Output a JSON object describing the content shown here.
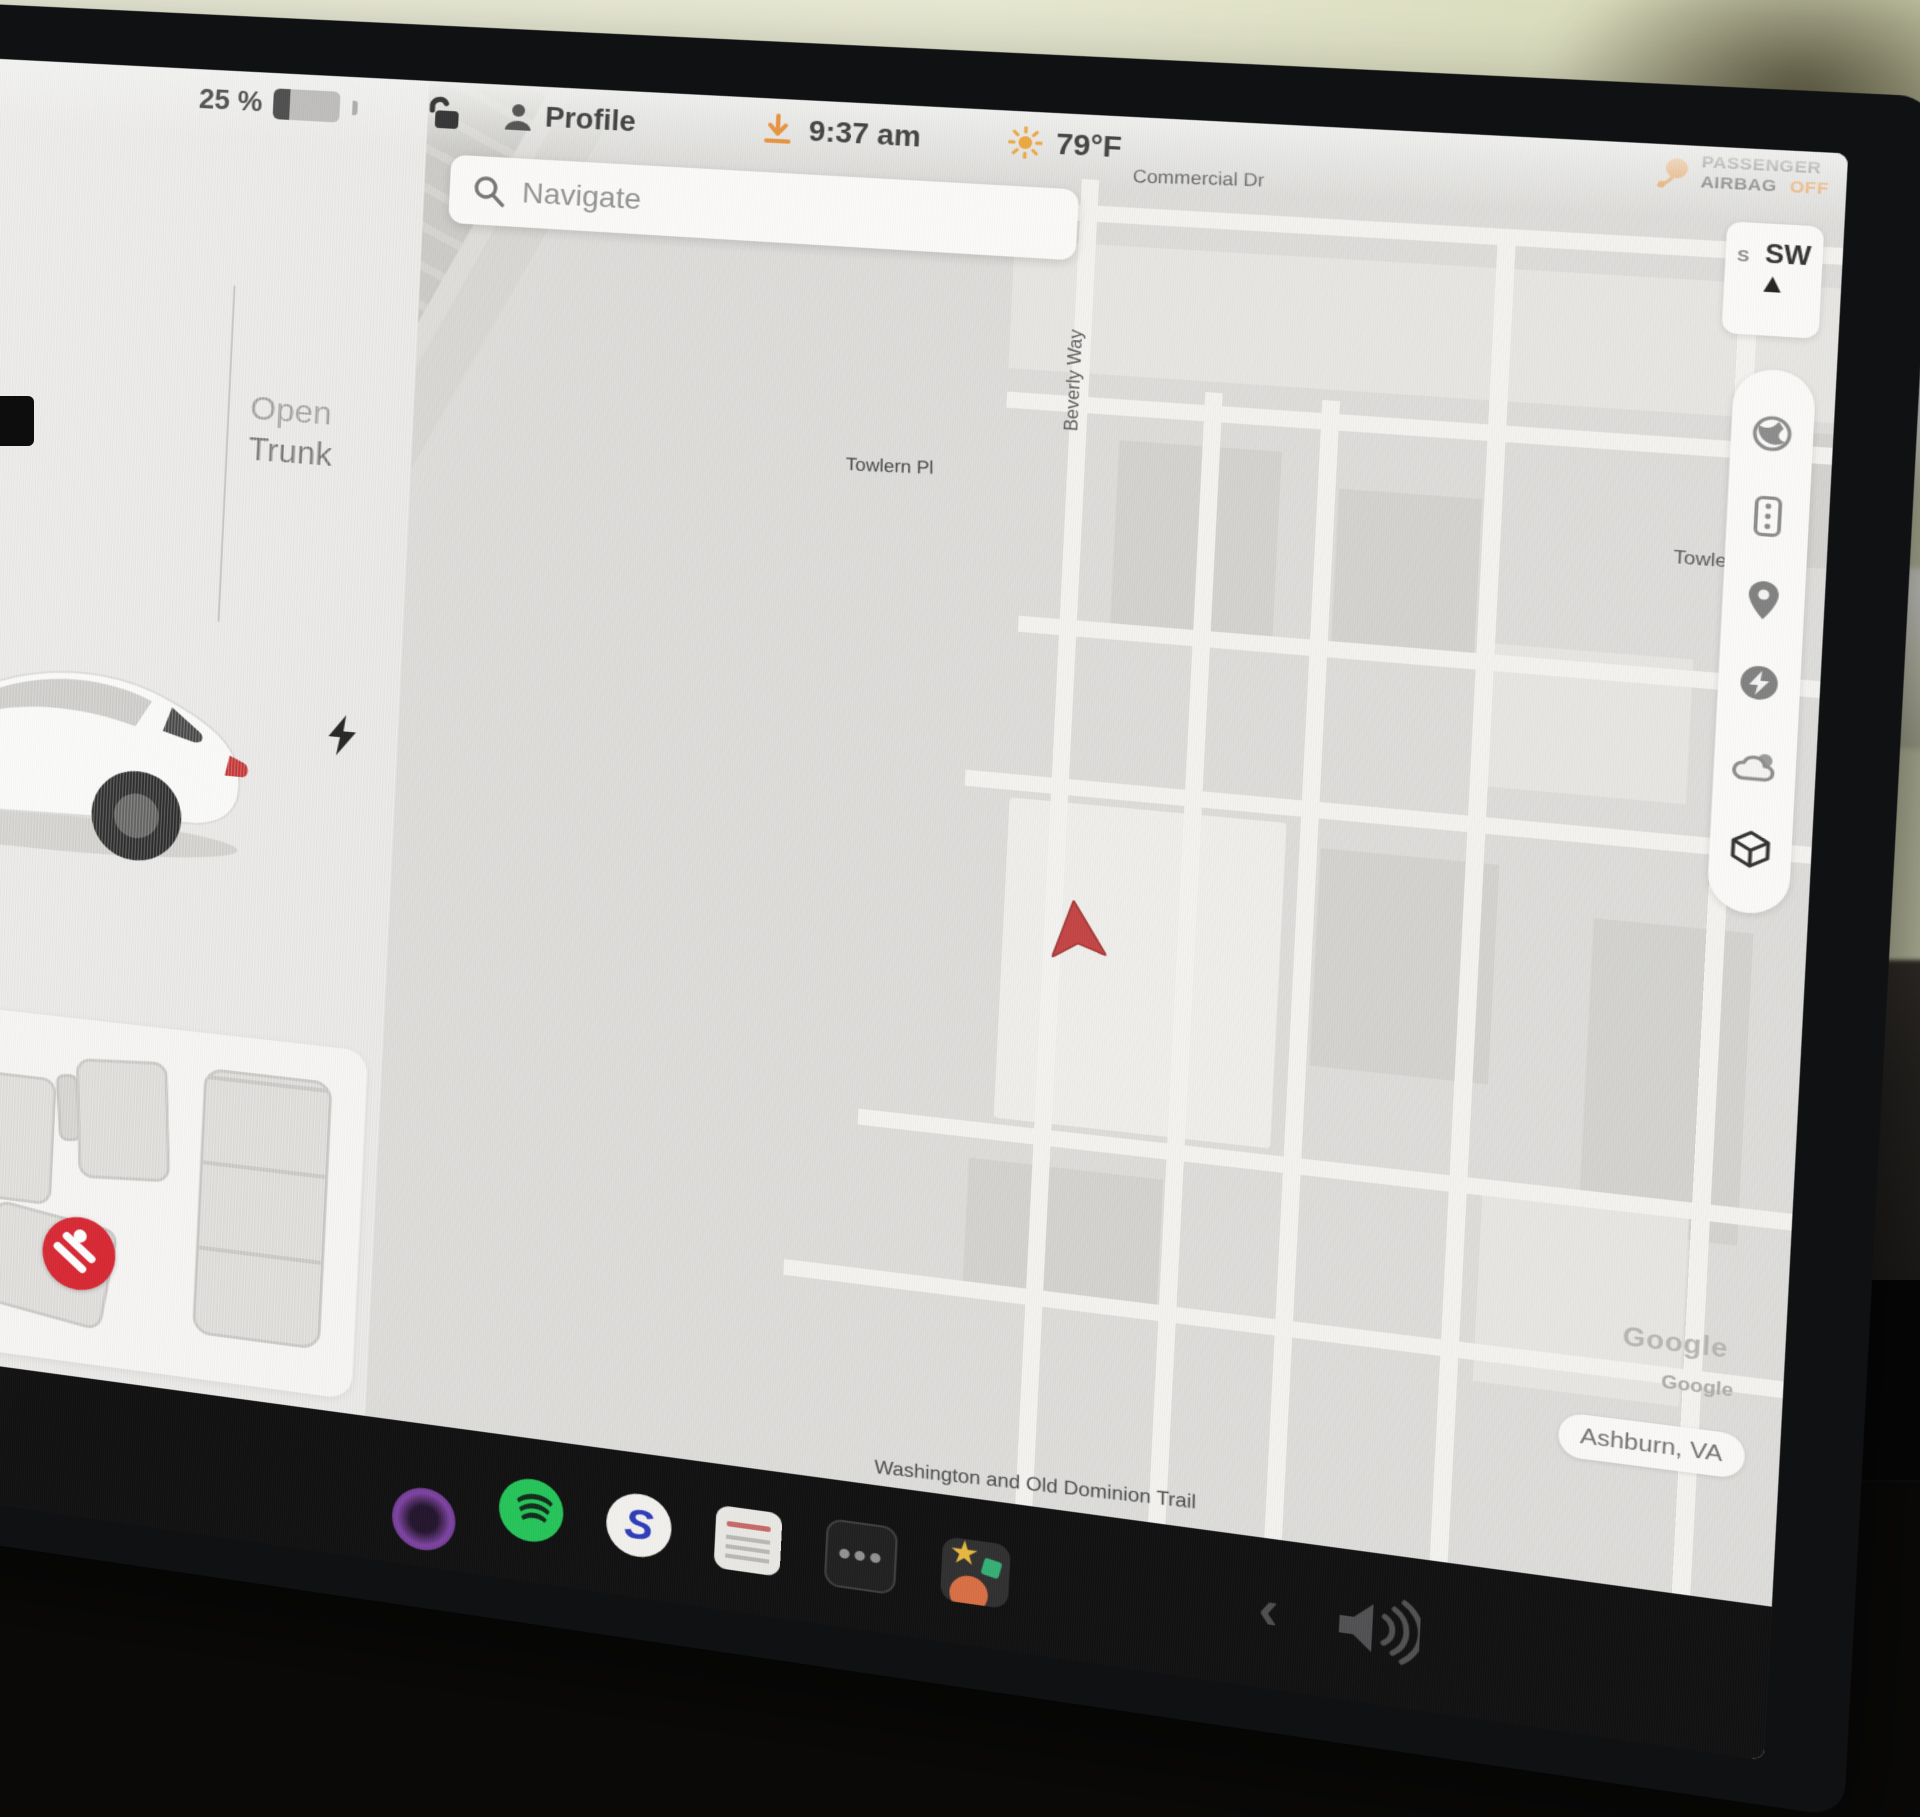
{
  "status_bar": {
    "battery_percent": "25 %",
    "battery_level": 25,
    "lock_icon": "unlocked-padlock",
    "profile_label": "Profile",
    "update_icon": "software-update-download",
    "time": "9:37 am",
    "weather_icon": "sun",
    "temperature": "79°F"
  },
  "left_panel": {
    "open_trunk": {
      "line1": "Open",
      "line2": "Trunk"
    },
    "charge_port_icon": "lightning-bolt",
    "seat_status_icon": "seatbelt-warning"
  },
  "search": {
    "placeholder": "Navigate",
    "icon": "magnifier"
  },
  "airbag": {
    "icon": "airbag-warning",
    "line1": "PASSENGER",
    "line2": "AIRBAG",
    "status": "OFF"
  },
  "compass": {
    "minor": "S",
    "heading": "SW",
    "arrow_glyph": "▲"
  },
  "map": {
    "streets": {
      "commercial": "Commercial Dr",
      "beverly": "Beverly Way",
      "towlern": "Towlern Pl",
      "towle_truncated": "Towle",
      "trail": "Washington and Old Dominion Trail"
    },
    "watermark": "Google",
    "watermark_shadow": "Google",
    "location_chip": "Ashburn, VA",
    "control_icons": [
      "satellite-view",
      "traffic-light",
      "map-pin",
      "superchargers",
      "weather",
      "view-3d"
    ]
  },
  "dock": {
    "apps": [
      "app-purple",
      "spotify",
      "app-s",
      "calendar",
      "more-apps",
      "toybox"
    ],
    "s_glyph": "S",
    "more_glyph": "•••",
    "toybox_star_glyph": "★",
    "back_glyph": "‹",
    "volume_icon": "speaker"
  },
  "colors": {
    "accent_orange": "#e8923d",
    "warning_red": "#d8222e",
    "spotify_green": "#1fc455",
    "s_blue": "#2737b8",
    "dock_black": "#0a0a0b"
  }
}
